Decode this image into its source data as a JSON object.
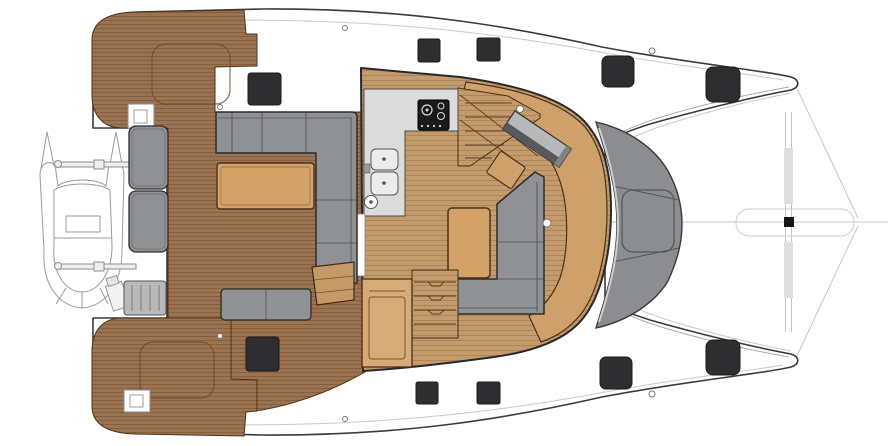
{
  "meta": {
    "title": "Catamaran deck and saloon floor plan",
    "view": "top-down",
    "bow_direction": "right",
    "stern_direction": "left"
  },
  "colors": {
    "background": "#ffffff",
    "hull_outline": "#3a3a3a",
    "gunwale_line": "#c9c9c9",
    "teak": "#9b7351",
    "teak_line": "#5e3c20",
    "sole": "#c49b6d",
    "sole_line": "#7a4f26",
    "furniture_tan": "#d2a269",
    "seat_tan": "#cfa06a",
    "cabinet_tan": "#d6ab77",
    "step_tan": "#c59a66",
    "sofa_gray": "#8f9194",
    "counter_gray": "#dcdcdc",
    "sink_gray": "#ececec",
    "stove_black": "#1a1a1a",
    "hatch_dark": "#2e2e30",
    "tramp_gray": "#8b8d90",
    "tramp_seam": "#54565a",
    "nav_gray": "#b6b8ba",
    "nav_bar": "#57595c",
    "sketch_gray": "#9a9a9a",
    "rigging_gray": "#c6c6c6",
    "fitting_black": "#161616"
  },
  "regions": {
    "aft_cockpit": {
      "label": "Aft cockpit",
      "furniture": [
        "L-shaped sofa",
        "cockpit table",
        "transom bench cushions",
        "aft bench",
        "helm step"
      ]
    },
    "saloon": {
      "label": "Saloon / galley",
      "furniture": [
        "galley counter",
        "3-burner stove",
        "double sink",
        "L-shaped sofa",
        "saloon table",
        "nav station",
        "cabinet",
        "companionway stairs starboard",
        "companionway stairs port"
      ]
    },
    "foredeck": {
      "label": "Foredeck",
      "items": [
        "forward lounge pad",
        "trampoline band",
        "bowsprit",
        "bridle lines"
      ]
    },
    "stern": {
      "label": "Transoms",
      "items": [
        "tender on davits",
        "outboard motor",
        "swim platforms",
        "engine hatches"
      ]
    }
  },
  "hatches": [
    {
      "x": 248,
      "y": 73,
      "w": 33,
      "h": 32,
      "r": 3
    },
    {
      "x": 418,
      "y": 39,
      "w": 22,
      "h": 23,
      "r": 2
    },
    {
      "x": 477,
      "y": 38,
      "w": 23,
      "h": 23,
      "r": 2
    },
    {
      "x": 602,
      "y": 56,
      "w": 32,
      "h": 31,
      "r": 6
    },
    {
      "x": 706,
      "y": 67,
      "w": 34,
      "h": 35,
      "r": 7
    },
    {
      "x": 246,
      "y": 337,
      "w": 33,
      "h": 34,
      "r": 3
    },
    {
      "x": 416,
      "y": 382,
      "w": 22,
      "h": 22,
      "r": 2
    },
    {
      "x": 477,
      "y": 382,
      "w": 23,
      "h": 22,
      "r": 2
    },
    {
      "x": 600,
      "y": 357,
      "w": 32,
      "h": 32,
      "r": 6
    },
    {
      "x": 706,
      "y": 340,
      "w": 34,
      "h": 35,
      "r": 7
    }
  ],
  "fittings": [
    {
      "cx": 345,
      "cy": 28,
      "r": 2.5
    },
    {
      "cx": 652,
      "cy": 51,
      "r": 3
    },
    {
      "cx": 220,
      "cy": 107,
      "r": 2.5
    },
    {
      "cx": 520,
      "cy": 109,
      "r": 3.5
    },
    {
      "cx": 547,
      "cy": 223,
      "r": 4
    },
    {
      "cx": 220,
      "cy": 336,
      "r": 2.5
    },
    {
      "cx": 345,
      "cy": 419,
      "r": 2.5
    },
    {
      "cx": 652,
      "cy": 394,
      "r": 3
    }
  ]
}
